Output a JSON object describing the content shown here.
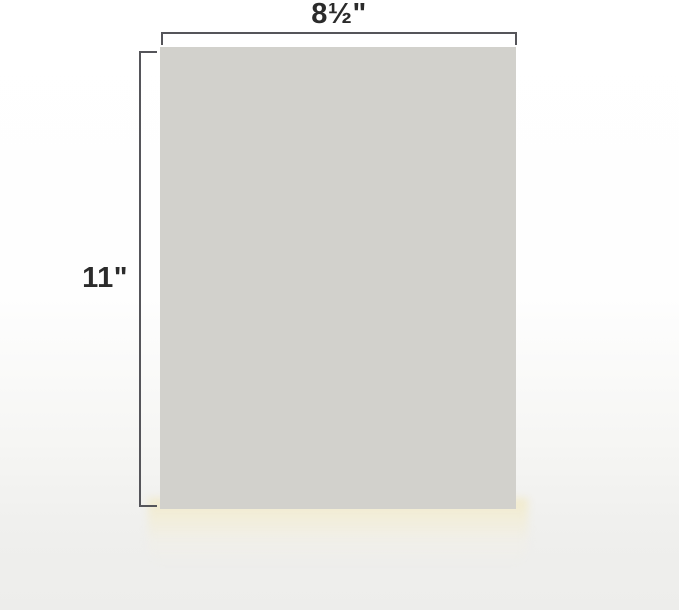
{
  "diagram": {
    "name": "letter-paper-dimensions",
    "paper": {
      "width_label": "8½\"",
      "height_label": "11\""
    },
    "colors": {
      "paper_fill": "#d2d1cc",
      "dimension_line": "#55555a",
      "label_text": "#2b2b2b",
      "background_top": "#ffffff",
      "background_bottom": "#ededeb",
      "under_paper_glow": "#f1eaca"
    }
  }
}
